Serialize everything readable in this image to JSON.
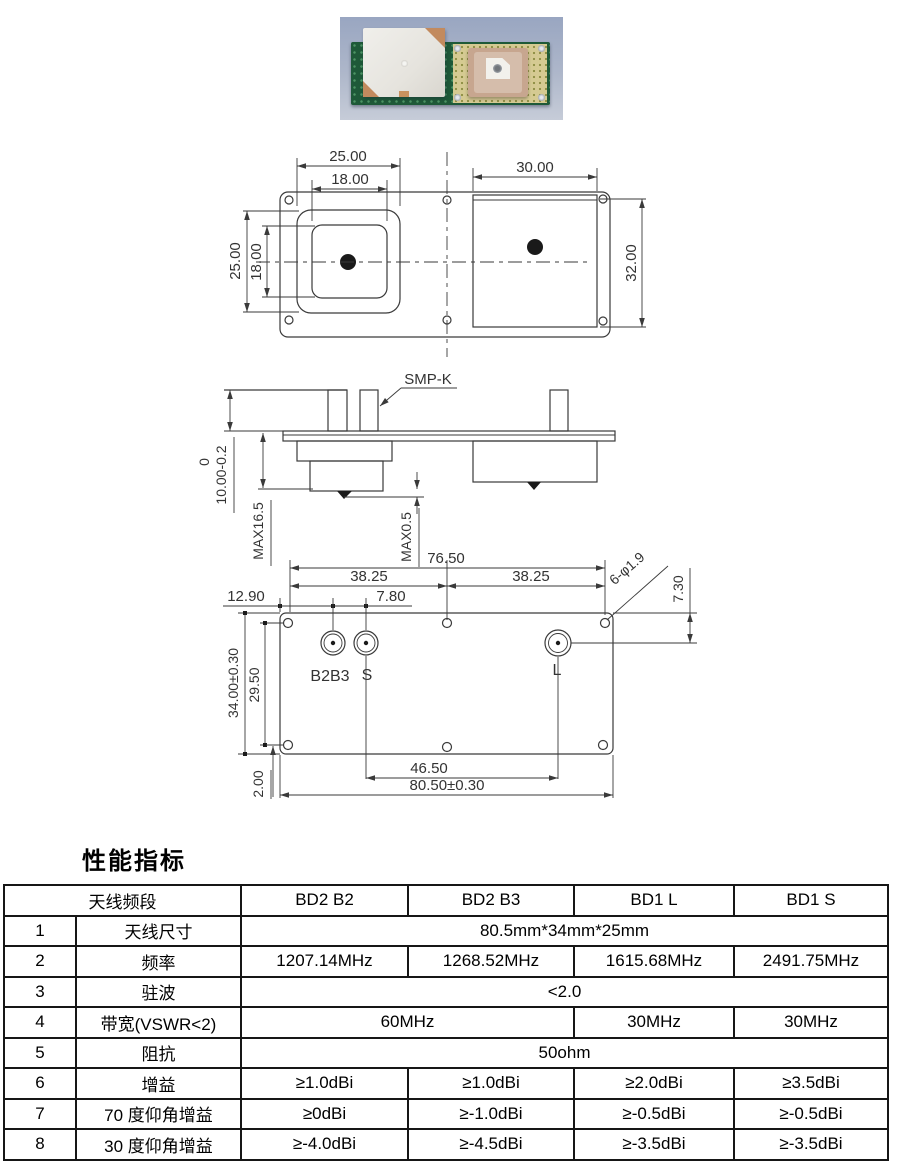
{
  "photo": {
    "description": "antenna module on blue cloth",
    "colors": {
      "background": "#a7b2c8",
      "pcb_green": "#1e5938",
      "ground_plane": "#d5ca92",
      "patch_left": "#e9e7e2",
      "patch_right": "#c7a68f"
    }
  },
  "drawings": {
    "top_view": {
      "dim_left_width": "25.00",
      "dim_left_inner_width": "18.00",
      "dim_right_width": "30.00",
      "dim_left_height": "25.00",
      "dim_left_inner_height": "18.00",
      "dim_right_height": "32.00"
    },
    "side_view": {
      "connector_label": "SMP-K",
      "dim_tol_upper": "0",
      "dim_connector_height": "10.00-0.2",
      "dim_max_total": "MAX16.5",
      "dim_max_pin": "MAX0.5"
    },
    "bottom_view": {
      "dim_hole_span": "76.50",
      "dim_half_span_left": "38.25",
      "dim_half_span_right": "38.25",
      "dim_edge_to_b2b3": "12.90",
      "dim_b2b3_to_s": "7.80",
      "dim_holes_note": "6-φ1.9",
      "dim_edge_to_l": "7.30",
      "dim_plate_height": "34.00±0.30",
      "dim_hole_spacing_v": "29.50",
      "dim_bottom_edge": "2.00",
      "dim_s_to_l": "46.50",
      "dim_plate_width": "80.50±0.30",
      "port_b2b3": "B2B3",
      "port_s": "S",
      "port_l": "L"
    }
  },
  "section_title": "性能指标",
  "table": {
    "header": {
      "band": "天线频段",
      "cols": [
        "BD2 B2",
        "BD2 B3",
        "BD1 L",
        "BD1 S"
      ]
    },
    "rows": [
      {
        "no": "1",
        "name": "天线尺寸",
        "cells": [
          {
            "text": "80.5mm*34mm*25mm"
          }
        ]
      },
      {
        "no": "2",
        "name": "频率",
        "cells": [
          {
            "text": "1207.14MHz"
          },
          {
            "text": "1268.52MHz"
          },
          {
            "text": "1615.68MHz"
          },
          {
            "text": "2491.75MHz"
          }
        ]
      },
      {
        "no": "3",
        "name": "驻波",
        "cells": [
          {
            "text": "<2.0"
          }
        ]
      },
      {
        "no": "4",
        "name": "带宽(VSWR<2)",
        "cells": [
          {
            "text": "60MHz"
          },
          {
            "text": "30MHz"
          },
          {
            "text": "30MHz"
          }
        ]
      },
      {
        "no": "5",
        "name": "阻抗",
        "cells": [
          {
            "text": "50ohm"
          }
        ]
      },
      {
        "no": "6",
        "name": "增益",
        "cells": [
          {
            "text": "≥1.0dBi"
          },
          {
            "text": "≥1.0dBi"
          },
          {
            "text": "≥2.0dBi"
          },
          {
            "text": "≥3.5dBi"
          }
        ]
      },
      {
        "no": "7",
        "name": "70 度仰角增益",
        "cells": [
          {
            "text": "≥0dBi"
          },
          {
            "text": "≥-1.0dBi"
          },
          {
            "text": "≥-0.5dBi"
          },
          {
            "text": "≥-0.5dBi"
          }
        ]
      },
      {
        "no": "8",
        "name": "30 度仰角增益",
        "cells": [
          {
            "text": "≥-4.0dBi"
          },
          {
            "text": "≥-4.5dBi"
          },
          {
            "text": "≥-3.5dBi"
          },
          {
            "text": "≥-3.5dBi"
          }
        ]
      }
    ]
  }
}
